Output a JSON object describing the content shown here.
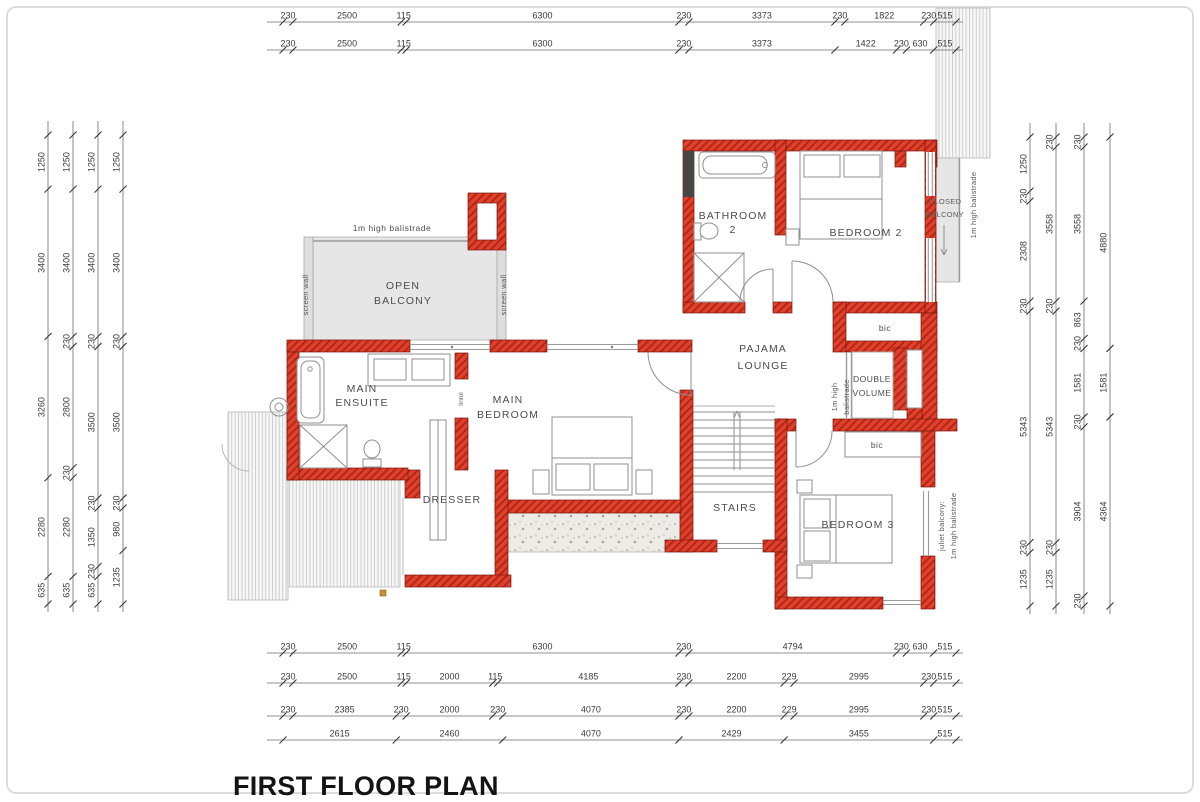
{
  "sheet": {
    "title": "FIRST FLOOR PLAN"
  },
  "labels": {
    "bathroom2_1": "BATHROOM",
    "bathroom2_2": "2",
    "bedroom2": "BEDROOM 2",
    "bedroom3": "BEDROOM 3",
    "closed_balcony_1": "CLOSED",
    "closed_balcony_2": "BALCONY",
    "open_balcony_1": "OPEN",
    "open_balcony_2": "BALCONY",
    "main_ensuite_1": "MAIN",
    "main_ensuite_2": "ENSUITE",
    "main_bedroom_1": "MAIN",
    "main_bedroom_2": "BEDROOM",
    "pajama_1": "PAJAMA",
    "pajama_2": "LOUNGE",
    "double_volume_1": "DOUBLE",
    "double_volume_2": "VOLUME",
    "stairs": "STAIRS",
    "dresser": "DRESSER",
    "bic_bedroom2": "bic",
    "bic_bedroom3": "bic",
    "balustrade_open_balcony": "1m high balistrade",
    "balustrade_closed_balcony": "1m high balistrade",
    "dv_balustrade_1": "1m high",
    "dv_balustrade_2": "balistrade",
    "screen_wall_left": "screen wall",
    "screen_wall_right": "screen wall",
    "juliet_1": "juliet balcony:",
    "juliet_2": "1m high balistrade",
    "lintol": "lintol"
  },
  "dimensions": {
    "top_rows": [
      [
        "230",
        "2500",
        "115",
        "6300",
        "230",
        "3373",
        "230",
        "1822",
        "230",
        "515"
      ],
      [
        "230",
        "2500",
        "115",
        "6300",
        "230",
        "3373",
        "1422",
        "230",
        "630",
        "515"
      ]
    ],
    "bottom_rows": [
      [
        "230",
        "2500",
        "115",
        "6300",
        "230",
        "4794",
        "230",
        "630",
        "515"
      ],
      [
        "230",
        "2500",
        "115",
        "2000",
        "115",
        "4185",
        "230",
        "2200",
        "229",
        "2995",
        "230",
        "515"
      ],
      [
        "230",
        "2385",
        "230",
        "2000",
        "230",
        "4070",
        "230",
        "2200",
        "229",
        "2995",
        "230",
        "515"
      ],
      [
        "2615",
        "2460",
        "4070",
        "2429",
        "3455",
        "515"
      ]
    ],
    "left_cols": [
      [
        "1250",
        "3400",
        "3260",
        "2280",
        "635"
      ],
      [
        "1250",
        "3400",
        "230",
        "2800",
        "230",
        "2280",
        "635"
      ],
      [
        "1250",
        "3400",
        "230",
        "3500",
        "230",
        "1350",
        "230",
        "635"
      ],
      [
        "1250",
        "3400",
        "230",
        "3500",
        "230",
        "980",
        "1235"
      ]
    ],
    "right_cols": [
      [
        "1250",
        "230",
        "2308",
        "230",
        "5343",
        "230",
        "1235"
      ],
      [
        "230",
        "3558",
        "230",
        "5343",
        "230",
        "1235"
      ],
      [
        "230",
        "3558",
        "863",
        "230",
        "1581",
        "230",
        "3904",
        "230"
      ],
      [
        "4880",
        "1581",
        "4364"
      ]
    ]
  },
  "colors": {
    "wall_red": "#e2402b",
    "wall_hatch": "#aa2718",
    "dim_text": "#3a3a3a",
    "fixture_grey": "#8f8f8f",
    "balcony_grey": "#e6e6e6"
  }
}
